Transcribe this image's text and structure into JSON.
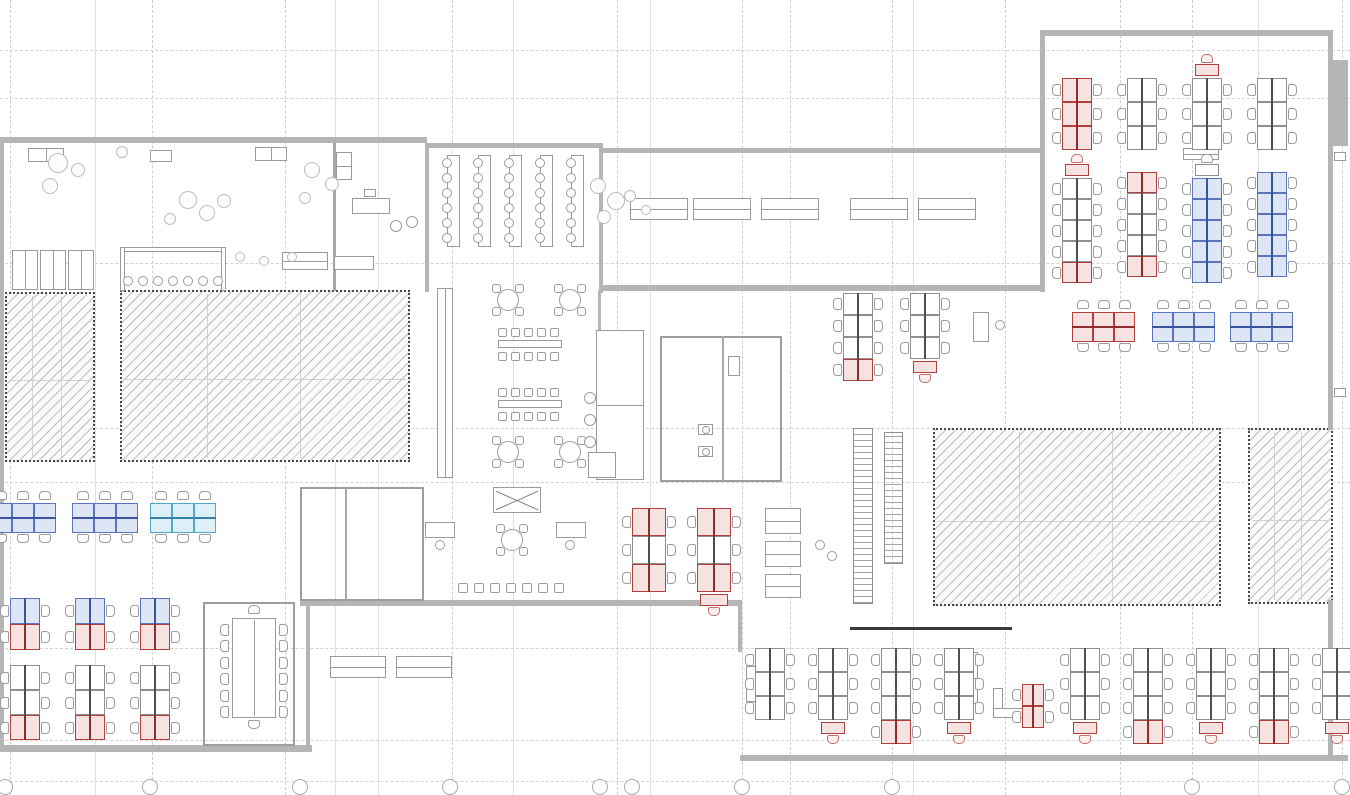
{
  "title": "Open-plan office floor plan drawing",
  "canvas": {
    "w": 1350,
    "h": 795,
    "bg": "#ffffff"
  },
  "palette": {
    "wall": "#b5b5b5",
    "dark_wall": "#3a3a3a",
    "grid": "#cfcfcf",
    "desk_red_stroke": "#b0403c",
    "desk_red_fill": "#f6e2e1",
    "desk_blue_stroke": "#5b74c0",
    "desk_blue_fill": "#dee5f5",
    "desk_cyan_stroke": "#53a8c9",
    "desk_cyan_fill": "#def0f7",
    "desk_gray_stroke": "#8f8f8f",
    "hatch_border": "#474747",
    "hatch_line": "#bdbdbd"
  },
  "grid": {
    "v_dashed": [
      10,
      152,
      285,
      452,
      617,
      742,
      790,
      892,
      1005,
      1120,
      1192,
      1342
    ],
    "v_solid": [
      95,
      335,
      378,
      513,
      650,
      913,
      1258
    ],
    "h_dashed": [
      50,
      98,
      263,
      428,
      482,
      648,
      740,
      781
    ],
    "bubbles": {
      "y": 779,
      "d": 16,
      "x": [
        5,
        150,
        300,
        450,
        600,
        632,
        742,
        892,
        1192,
        1342
      ]
    }
  },
  "walls": [
    [
      0,
      137,
      427,
      6
    ],
    [
      0,
      137,
      4,
      614
    ],
    [
      0,
      745,
      312,
      7
    ],
    [
      425,
      143,
      4,
      149
    ],
    [
      425,
      143,
      178,
      5
    ],
    [
      599,
      143,
      4,
      150
    ],
    [
      600,
      148,
      442,
      5
    ],
    [
      600,
      285,
      442,
      6
    ],
    [
      1040,
      30,
      292,
      6
    ],
    [
      1040,
      30,
      5,
      262
    ],
    [
      1328,
      30,
      5,
      400
    ],
    [
      1330,
      60,
      18,
      86
    ],
    [
      740,
      755,
      608,
      6
    ],
    [
      1328,
      600,
      5,
      161
    ],
    [
      738,
      600,
      4,
      52
    ],
    [
      300,
      600,
      440,
      6
    ],
    [
      306,
      600,
      4,
      149
    ],
    [
      598,
      290,
      3,
      190
    ]
  ],
  "dark_walls": [
    [
      850,
      627,
      162,
      3
    ]
  ],
  "hatch_zones": [
    {
      "x": 5,
      "y": 292,
      "w": 90,
      "h": 170,
      "name": "core-zone-a"
    },
    {
      "x": 120,
      "y": 290,
      "w": 290,
      "h": 172,
      "name": "core-zone-b"
    },
    {
      "x": 933,
      "y": 428,
      "w": 288,
      "h": 178,
      "name": "core-zone-c"
    },
    {
      "x": 1248,
      "y": 428,
      "w": 85,
      "h": 176,
      "name": "core-zone-d"
    }
  ],
  "rooms": [
    [
      203,
      602,
      92,
      144
    ],
    [
      300,
      487,
      124,
      114
    ],
    [
      660,
      336,
      122,
      146
    ]
  ],
  "partitions": [
    [
      345,
      487,
      2,
      114
    ],
    [
      722,
      336,
      2,
      146
    ],
    [
      333,
      143,
      3,
      148
    ]
  ],
  "desk_banks": [
    {
      "o": "v",
      "x": 1062,
      "y": 78,
      "u": 24,
      "w": 30,
      "units": [
        "red",
        "red",
        "red"
      ]
    },
    {
      "o": "v",
      "x": 1127,
      "y": 78,
      "u": 24,
      "w": 30,
      "units": [
        "gray",
        "gray",
        "gray"
      ]
    },
    {
      "o": "v",
      "x": 1192,
      "y": 78,
      "u": 24,
      "w": 30,
      "units": [
        "gray",
        "gray",
        "gray"
      ],
      "cap_top": "red"
    },
    {
      "o": "v",
      "x": 1257,
      "y": 78,
      "u": 24,
      "w": 30,
      "units": [
        "gray",
        "gray",
        "gray"
      ]
    },
    {
      "o": "v",
      "x": 1062,
      "y": 178,
      "u": 21,
      "w": 30,
      "units": [
        "gray",
        "gray",
        "gray",
        "gray",
        "red"
      ],
      "cap_top": "red"
    },
    {
      "o": "v",
      "x": 1127,
      "y": 172,
      "u": 21,
      "w": 30,
      "units": [
        "red",
        "gray",
        "gray",
        "gray",
        "red"
      ]
    },
    {
      "o": "v",
      "x": 1192,
      "y": 178,
      "u": 21,
      "w": 30,
      "units": [
        "blue",
        "blue",
        "blue",
        "blue",
        "blue"
      ],
      "cap_top": "gray"
    },
    {
      "o": "v",
      "x": 1257,
      "y": 172,
      "u": 21,
      "w": 30,
      "units": [
        "blue",
        "blue",
        "blue",
        "blue",
        "blue"
      ]
    },
    {
      "o": "h",
      "x": 1072,
      "y": 312,
      "u": 21,
      "w": 30,
      "units": [
        "red",
        "red",
        "red"
      ]
    },
    {
      "o": "h",
      "x": 1152,
      "y": 312,
      "u": 21,
      "w": 30,
      "units": [
        "blue",
        "blue",
        "blue"
      ]
    },
    {
      "o": "h",
      "x": 1230,
      "y": 312,
      "u": 21,
      "w": 30,
      "units": [
        "blue",
        "blue",
        "blue"
      ]
    },
    {
      "o": "v",
      "x": 843,
      "y": 293,
      "u": 22,
      "w": 30,
      "units": [
        "gray",
        "gray",
        "gray",
        "red"
      ]
    },
    {
      "o": "v",
      "x": 910,
      "y": 293,
      "u": 22,
      "w": 30,
      "units": [
        "gray",
        "gray",
        "gray"
      ],
      "cap_bottom": "red"
    },
    {
      "o": "v",
      "x": 632,
      "y": 508,
      "u": 28,
      "w": 34,
      "units": [
        "red",
        "gray",
        "red"
      ]
    },
    {
      "o": "v",
      "x": 697,
      "y": 508,
      "u": 28,
      "w": 34,
      "units": [
        "red",
        "gray",
        "red"
      ],
      "cap_bottom": "red"
    },
    {
      "o": "h",
      "x": -10,
      "y": 503,
      "u": 22,
      "w": 30,
      "units": [
        "blue",
        "blue",
        "blue"
      ]
    },
    {
      "o": "h",
      "x": 72,
      "y": 503,
      "u": 22,
      "w": 30,
      "units": [
        "blue",
        "blue",
        "blue"
      ]
    },
    {
      "o": "h",
      "x": 150,
      "y": 503,
      "u": 22,
      "w": 30,
      "units": [
        "cyan",
        "cyan",
        "cyan"
      ]
    },
    {
      "o": "v",
      "x": 10,
      "y": 598,
      "u": 26,
      "w": 30,
      "units": [
        "blue",
        "red"
      ]
    },
    {
      "o": "v",
      "x": 75,
      "y": 598,
      "u": 26,
      "w": 30,
      "units": [
        "blue",
        "red"
      ]
    },
    {
      "o": "v",
      "x": 140,
      "y": 598,
      "u": 26,
      "w": 30,
      "units": [
        "blue",
        "red"
      ]
    },
    {
      "o": "v",
      "x": 10,
      "y": 665,
      "u": 25,
      "w": 30,
      "units": [
        "gray",
        "gray",
        "red"
      ]
    },
    {
      "o": "v",
      "x": 75,
      "y": 665,
      "u": 25,
      "w": 30,
      "units": [
        "gray",
        "gray",
        "red"
      ]
    },
    {
      "o": "v",
      "x": 140,
      "y": 665,
      "u": 25,
      "w": 30,
      "units": [
        "gray",
        "gray",
        "red"
      ]
    },
    {
      "o": "v",
      "x": 755,
      "y": 648,
      "u": 24,
      "w": 30,
      "units": [
        "gray",
        "gray",
        "gray"
      ]
    },
    {
      "o": "v",
      "x": 818,
      "y": 648,
      "u": 24,
      "w": 30,
      "units": [
        "gray",
        "gray",
        "gray"
      ],
      "cap_bottom": "red"
    },
    {
      "o": "v",
      "x": 881,
      "y": 648,
      "u": 24,
      "w": 30,
      "units": [
        "gray",
        "gray",
        "gray",
        "red"
      ]
    },
    {
      "o": "v",
      "x": 944,
      "y": 648,
      "u": 24,
      "w": 30,
      "units": [
        "gray",
        "gray",
        "gray"
      ],
      "cap_bottom": "red"
    },
    {
      "o": "v",
      "x": 1070,
      "y": 648,
      "u": 24,
      "w": 30,
      "units": [
        "gray",
        "gray",
        "gray"
      ],
      "cap_bottom": "red"
    },
    {
      "o": "v",
      "x": 1133,
      "y": 648,
      "u": 24,
      "w": 30,
      "units": [
        "gray",
        "gray",
        "gray",
        "red"
      ]
    },
    {
      "o": "v",
      "x": 1196,
      "y": 648,
      "u": 24,
      "w": 30,
      "units": [
        "gray",
        "gray",
        "gray"
      ],
      "cap_bottom": "red"
    },
    {
      "o": "v",
      "x": 1259,
      "y": 648,
      "u": 24,
      "w": 30,
      "units": [
        "gray",
        "gray",
        "gray",
        "red"
      ]
    },
    {
      "o": "v",
      "x": 1322,
      "y": 648,
      "u": 24,
      "w": 30,
      "units": [
        "gray",
        "gray",
        "gray"
      ],
      "cap_bottom": "red"
    },
    {
      "o": "v",
      "x": 1022,
      "y": 684,
      "u": 22,
      "w": 22,
      "units": [
        "red",
        "red"
      ]
    }
  ],
  "misc_rects": [
    [
      28,
      148,
      36,
      14,
      "vline"
    ],
    [
      150,
      150,
      22,
      12,
      "plain"
    ],
    [
      255,
      147,
      32,
      14,
      "vline"
    ],
    [
      336,
      152,
      16,
      28,
      "hline"
    ],
    [
      352,
      198,
      38,
      16,
      "plain"
    ],
    [
      364,
      189,
      12,
      8,
      "plain"
    ],
    [
      12,
      250,
      26,
      40,
      "vline"
    ],
    [
      40,
      250,
      26,
      40,
      "vline"
    ],
    [
      68,
      250,
      26,
      40,
      "vline"
    ],
    [
      120,
      247,
      106,
      5,
      "plain"
    ],
    [
      120,
      247,
      5,
      44,
      "plain"
    ],
    [
      221,
      247,
      5,
      44,
      "plain"
    ],
    [
      282,
      252,
      46,
      18,
      "hline"
    ],
    [
      334,
      256,
      40,
      14,
      "plain"
    ],
    [
      437,
      288,
      16,
      190,
      "vline"
    ],
    [
      596,
      330,
      48,
      150,
      "hline"
    ],
    [
      588,
      452,
      28,
      26,
      "plain"
    ],
    [
      958,
      652,
      20,
      52,
      "hline"
    ],
    [
      973,
      312,
      16,
      30,
      "plain"
    ],
    [
      746,
      692,
      34,
      10,
      "plain"
    ],
    [
      746,
      666,
      10,
      36,
      "plain"
    ],
    [
      993,
      688,
      10,
      30,
      "plain"
    ],
    [
      993,
      708,
      36,
      10,
      "plain"
    ],
    [
      1183,
      148,
      36,
      12,
      "hline"
    ],
    [
      630,
      198,
      58,
      22,
      "hline"
    ],
    [
      693,
      198,
      58,
      22,
      "hline"
    ],
    [
      761,
      198,
      58,
      22,
      "hline"
    ],
    [
      850,
      198,
      58,
      22,
      "hline"
    ],
    [
      918,
      198,
      58,
      22,
      "hline"
    ],
    [
      330,
      656,
      56,
      22,
      "hline"
    ],
    [
      396,
      656,
      56,
      22,
      "hline"
    ],
    [
      493,
      487,
      48,
      26,
      "cross"
    ],
    [
      765,
      508,
      36,
      26,
      "hline"
    ],
    [
      765,
      541,
      36,
      26,
      "hline"
    ],
    [
      765,
      574,
      36,
      24,
      "hline"
    ],
    [
      425,
      522,
      30,
      16,
      "plain"
    ],
    [
      556,
      522,
      30,
      16,
      "plain"
    ],
    [
      698,
      424,
      15,
      11,
      "plain"
    ],
    [
      698,
      446,
      15,
      11,
      "plain"
    ],
    [
      728,
      356,
      12,
      20,
      "plain"
    ],
    [
      1334,
      152,
      12,
      9,
      "plain"
    ],
    [
      1334,
      388,
      12,
      9,
      "plain"
    ]
  ],
  "stairs": [
    [
      853,
      428,
      20,
      176
    ],
    [
      884,
      432,
      19,
      132
    ]
  ],
  "round_tables": [
    [
      508,
      300
    ],
    [
      570,
      300
    ],
    [
      508,
      452
    ],
    [
      570,
      452
    ],
    [
      512,
      540
    ]
  ],
  "canteen_groups": [
    {
      "x": 498,
      "y": 328
    },
    {
      "x": 498,
      "y": 388
    }
  ],
  "canteen_style": {
    "chairs": 5,
    "chair_step": 13,
    "chair_size": 9,
    "table_w": 64,
    "table_h": 8,
    "row_gap": 24
  },
  "chair_square_rows": [
    {
      "x": 458,
      "y": 583,
      "n": 7,
      "step": 16,
      "s": 10
    }
  ],
  "stool_rows": [
    {
      "x": 128,
      "y": 281,
      "n": 7,
      "step": 15,
      "r": 5
    }
  ],
  "training": {
    "x0": 447,
    "y": 155,
    "cols": 5,
    "step": 31,
    "tw": 13,
    "th": 92,
    "chairs": 6,
    "chair_step": 15
  },
  "conference": {
    "x": 232,
    "y": 618,
    "w": 44,
    "h": 100,
    "chairs_side": 6
  },
  "blobs": [
    [
      58,
      163,
      10
    ],
    [
      78,
      170,
      7
    ],
    [
      50,
      186,
      8
    ],
    [
      122,
      152,
      6
    ],
    [
      188,
      200,
      9
    ],
    [
      207,
      213,
      8
    ],
    [
      224,
      201,
      7
    ],
    [
      170,
      219,
      6
    ],
    [
      312,
      170,
      8
    ],
    [
      332,
      184,
      7
    ],
    [
      305,
      198,
      6
    ],
    [
      240,
      257,
      5
    ],
    [
      264,
      261,
      5
    ],
    [
      292,
      257,
      5
    ],
    [
      598,
      186,
      8
    ],
    [
      616,
      201,
      9
    ],
    [
      604,
      217,
      7
    ],
    [
      630,
      196,
      6
    ],
    [
      646,
      210,
      5
    ]
  ],
  "small_circles": [
    [
      440,
      545,
      5
    ],
    [
      570,
      545,
      5
    ],
    [
      1000,
      325,
      5
    ],
    [
      820,
      545,
      5
    ],
    [
      832,
      556,
      5
    ],
    [
      706,
      430,
      4
    ],
    [
      706,
      452,
      4
    ],
    [
      396,
      226,
      6
    ],
    [
      412,
      222,
      6
    ],
    [
      590,
      398,
      6
    ],
    [
      590,
      420,
      6
    ],
    [
      590,
      442,
      6
    ]
  ]
}
